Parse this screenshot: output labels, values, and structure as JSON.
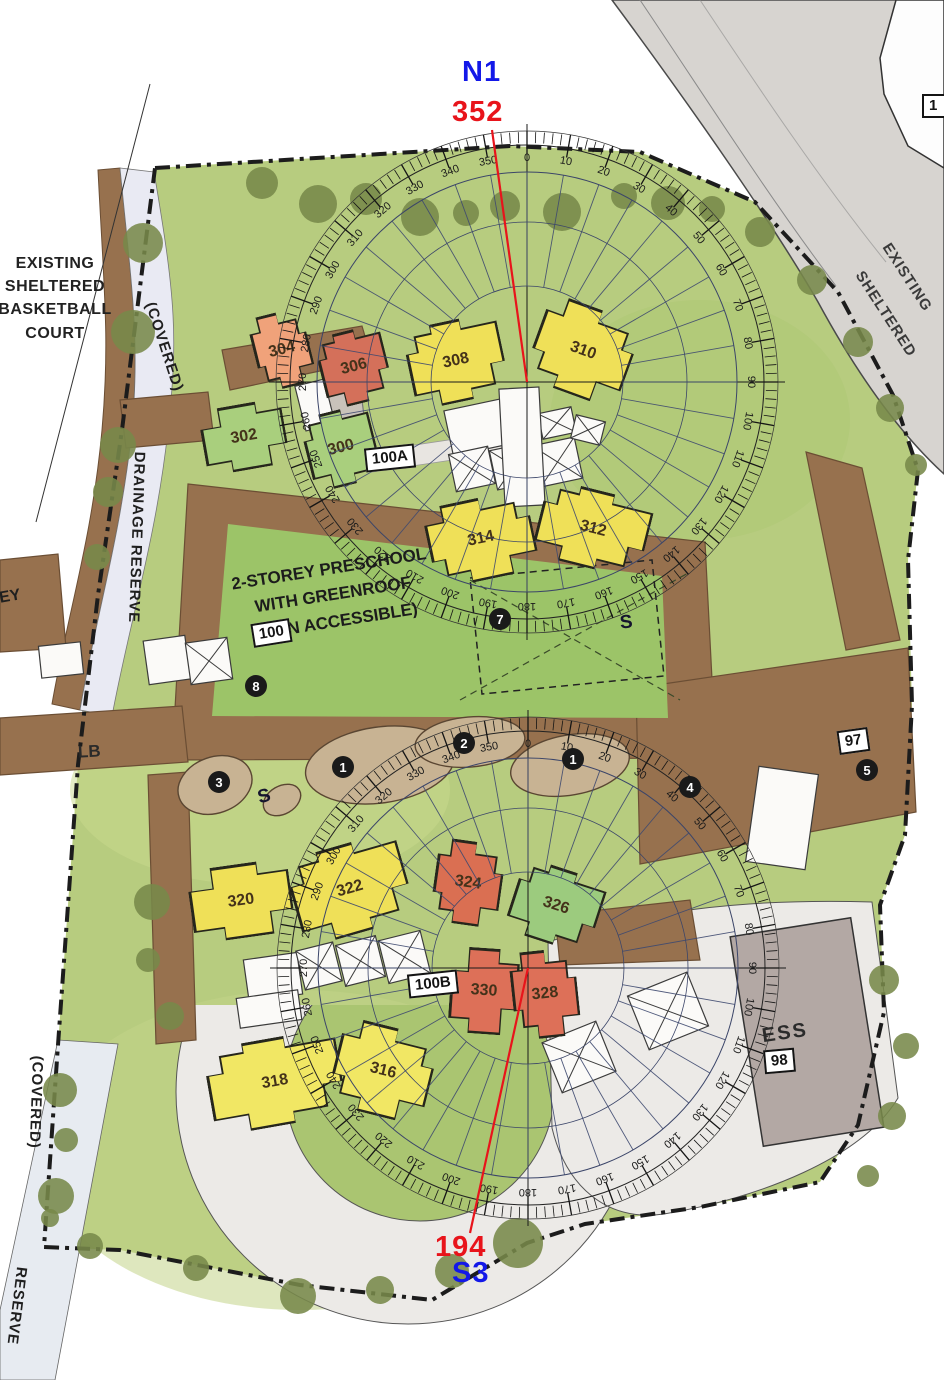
{
  "annotations": {
    "north_zone": "N1",
    "north_bearing": "352",
    "south_bearing": "194",
    "south_zone": "S3"
  },
  "colors": {
    "bearing_line": "#e8141b",
    "zone_text": "#1318e8",
    "site_green": "#b7cc7f",
    "path_brown": "#97714e",
    "road_grey": "#d7d4d0",
    "ess_grey": "#b3a8a4",
    "tree_green": "#78894a",
    "drainage_strip": "#e9eaf3"
  },
  "buildings": [
    {
      "label": "304",
      "color": "#f0a27a"
    },
    {
      "label": "306",
      "color": "#d4705a"
    },
    {
      "label": "308",
      "color": "#efe058"
    },
    {
      "label": "310",
      "color": "#efe058"
    },
    {
      "label": "302",
      "color": "#a9cf7d"
    },
    {
      "label": "300",
      "color": "#a9cf7d"
    },
    {
      "label": "314",
      "color": "#efe058"
    },
    {
      "label": "312",
      "color": "#efe058"
    },
    {
      "label": "320",
      "color": "#efe058"
    },
    {
      "label": "322",
      "color": "#efe058"
    },
    {
      "label": "324",
      "color": "#da6f52"
    },
    {
      "label": "326",
      "color": "#9ccb7e"
    },
    {
      "label": "330",
      "color": "#dd7058"
    },
    {
      "label": "328",
      "color": "#dd7058"
    },
    {
      "label": "318",
      "color": "#f1e764"
    },
    {
      "label": "316",
      "color": "#f1e764"
    }
  ],
  "markers": [
    "1",
    "2",
    "1",
    "3",
    "4",
    "5",
    "7",
    "8"
  ],
  "s_markers": [
    "S",
    "S"
  ],
  "boxes": {
    "cluster_a": "100A",
    "cluster_b": "100B",
    "preschool": "100",
    "plaza": "97",
    "ess": "98",
    "corner": "1"
  },
  "texts": {
    "court": [
      "EXISTING",
      "SHELTERED",
      "BASKETBALL",
      "COURT"
    ],
    "preschool": [
      "2-STOREY PRESCHOOL",
      "WITH GREENROOF",
      "(NON ACCESSIBLE)"
    ],
    "drainage_reserve": "DRAINAGE RESERVE",
    "covered_top": "(COVERED)",
    "covered_bottom": "(COVERED)",
    "reserve_bottom": "RESERVE",
    "road": [
      "EXISTING",
      "SHELTERED"
    ],
    "edge_fragment": "EY",
    "lb": "LB",
    "ess": "ESS"
  },
  "compass": {
    "tick_step_deg": 10,
    "labels": [
      "0",
      "10",
      "20",
      "30",
      "40",
      "50",
      "60",
      "70",
      "80",
      "90",
      "100",
      "110",
      "120",
      "130",
      "140",
      "150",
      "160",
      "170",
      "180",
      "190",
      "200",
      "210",
      "220",
      "230",
      "240",
      "250",
      "260",
      "270",
      "280",
      "290",
      "300",
      "310",
      "320",
      "330",
      "340",
      "350"
    ]
  }
}
